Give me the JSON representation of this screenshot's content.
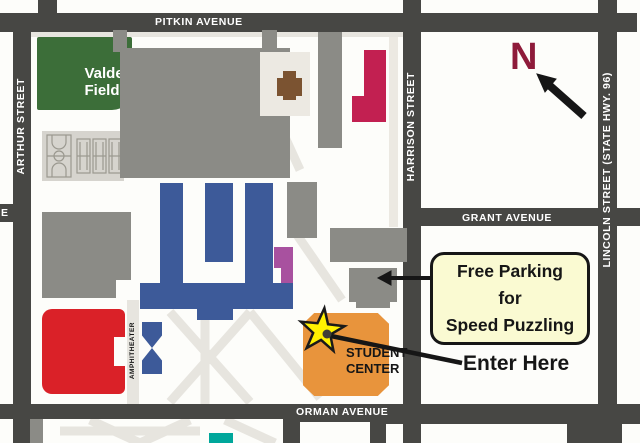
{
  "streets": {
    "pitkin": "PITKIN AVENUE",
    "arthur": "ARTHUR STREET",
    "harrison": "HARRISON STREET",
    "lincoln": "LINCOLN STREET (STATE HWY. 96)",
    "grant": "GRANT AVENUE",
    "orman": "ORMAN AVENUE",
    "edge_partial_label": "E"
  },
  "places": {
    "valdez_line1": "Valdez",
    "valdez_line2": "Field",
    "student_center_line1": "STUDENT",
    "student_center_line2": "CENTER",
    "amphitheater": "AMPHITHEATER"
  },
  "annotations": {
    "north_letter": "N",
    "callout_line1": "Free Parking",
    "callout_line2": "for",
    "callout_line3": "Speed Puzzling",
    "enter_here": "Enter Here"
  },
  "colors": {
    "street": "#474744",
    "building_gray": "#8b8b86",
    "path_gray": "#e7e5df",
    "field_green": "#3c6e39",
    "building_blue": "#3d5a99",
    "building_red": "#da2128",
    "building_crimson": "#c22051",
    "building_purple": "#a8519f",
    "building_brown": "#7b5331",
    "student_center_orange": "#e8943c",
    "building_teal": "#00a79b",
    "courts_panel": "#d6d4ce",
    "star_yellow": "#fff200",
    "callout_bg": "#fafad2",
    "north_maroon": "#8e1b3a",
    "ink": "#161616"
  }
}
